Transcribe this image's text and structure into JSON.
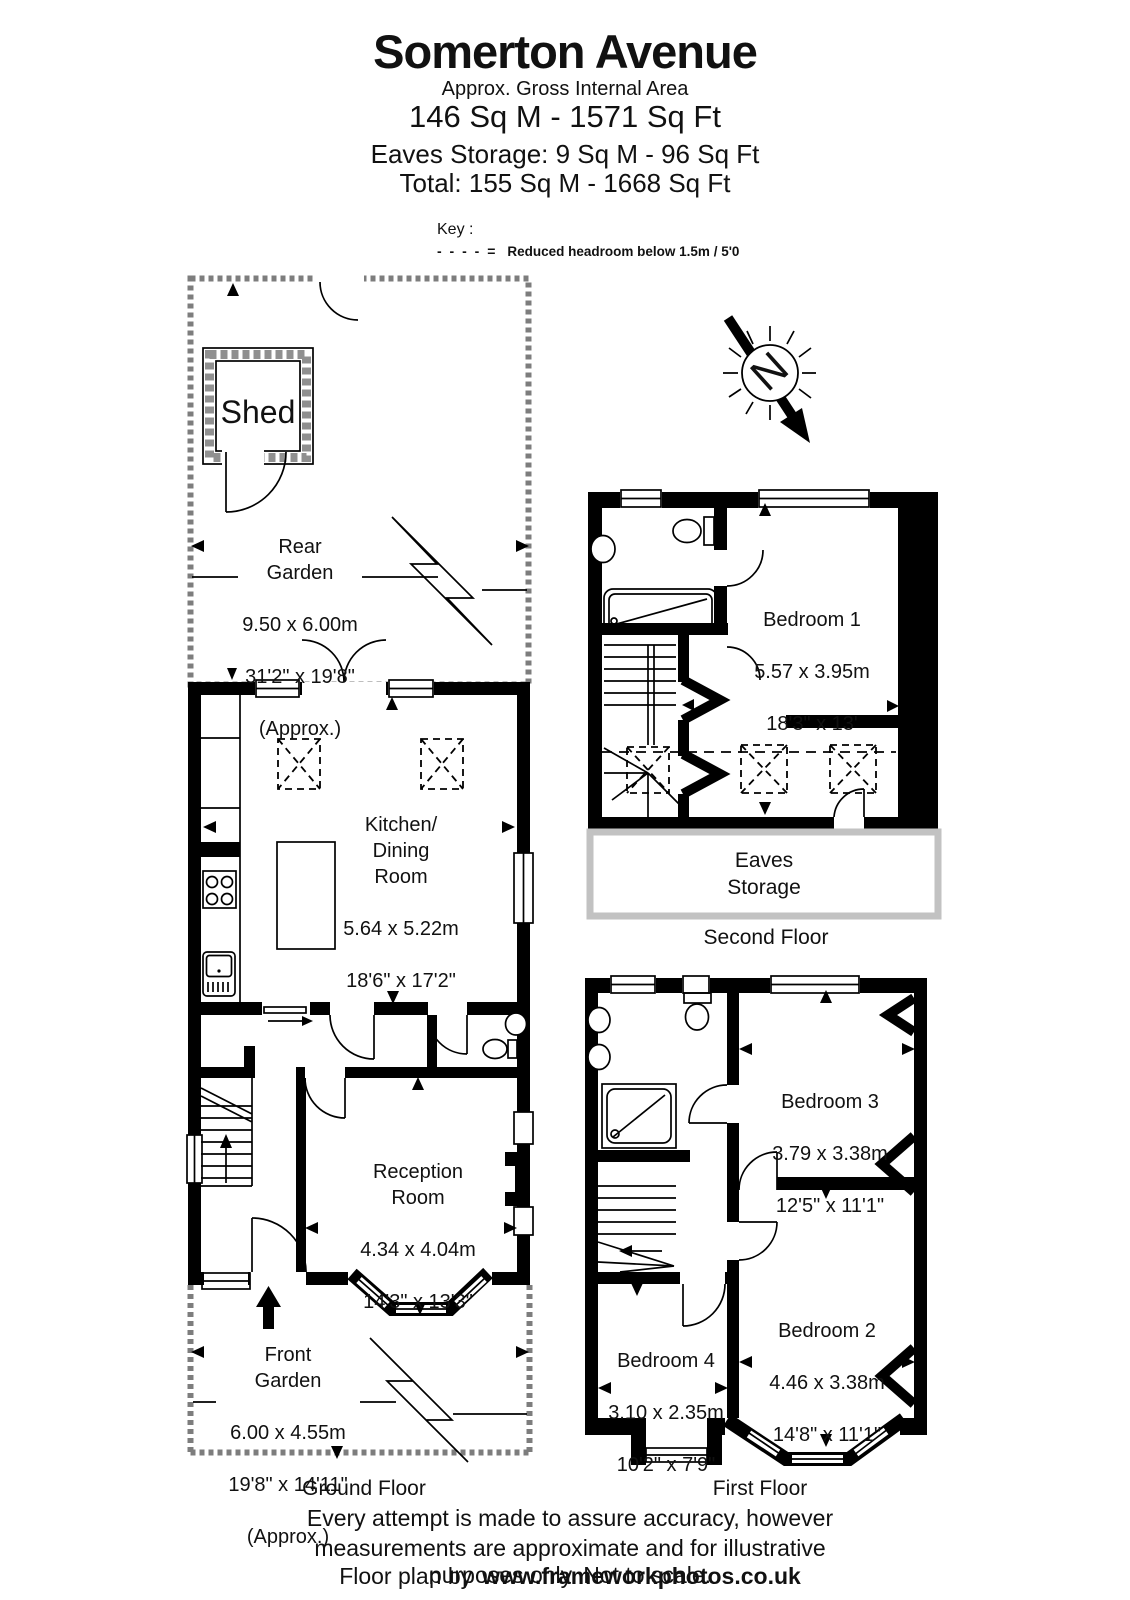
{
  "header": {
    "title": "Somerton Avenue",
    "subtitle": "Approx. Gross Internal Area",
    "area_main": "146 Sq M - 1571 Sq Ft",
    "area_eaves": "Eaves Storage: 9 Sq M - 96 Sq Ft",
    "area_total": "Total: 155 Sq M - 1668 Sq Ft"
  },
  "key": {
    "label": "Key :",
    "symbol": "- - - - =",
    "description": "Reduced headroom below 1.5m / 5'0"
  },
  "compass": {
    "north_label": "N"
  },
  "ground_floor": {
    "floor_label": "Ground Floor",
    "rear_garden": {
      "name": "Rear\nGarden",
      "metric": "9.50 x 6.00m",
      "imperial": "31'2\" x 19'8\"",
      "approx": "(Approx.)"
    },
    "shed": {
      "name": "Shed"
    },
    "kitchen": {
      "name": "Kitchen/\nDining\nRoom",
      "metric": "5.64 x 5.22m",
      "imperial": "18'6\" x 17'2\""
    },
    "reception": {
      "name": "Reception\nRoom",
      "metric": "4.34 x 4.04m",
      "imperial": "14'3\" x 13'3\""
    },
    "front_garden": {
      "name": "Front\nGarden",
      "metric": "6.00 x 4.55m",
      "imperial": "19'8\" x 14'11\"",
      "approx": "(Approx.)"
    }
  },
  "first_floor": {
    "floor_label": "First Floor",
    "bedroom2": {
      "name": "Bedroom 2",
      "metric": "4.46 x 3.38m",
      "imperial": "14'8\" x 11'1\""
    },
    "bedroom3": {
      "name": "Bedroom 3",
      "metric": "3.79 x 3.38m",
      "imperial": "12'5\" x 11'1\""
    },
    "bedroom4": {
      "name": "Bedroom 4",
      "metric": "3.10 x 2.35m",
      "imperial": "10'2\" x 7'9\""
    }
  },
  "second_floor": {
    "floor_label": "Second Floor",
    "bedroom1": {
      "name": "Bedroom 1",
      "metric": "5.57 x 3.95m",
      "imperial": "18'3\" x 13'"
    },
    "eaves_storage": {
      "name": "Eaves\nStorage"
    }
  },
  "footer": {
    "line1": "Every attempt is made to assure accuracy, however",
    "line2": "measurements are approximate and for illustrative purposes only. Not to scale.",
    "credit_prefix": "Floor plan by",
    "credit_url": "www.frameworkphotos.co.uk"
  }
}
